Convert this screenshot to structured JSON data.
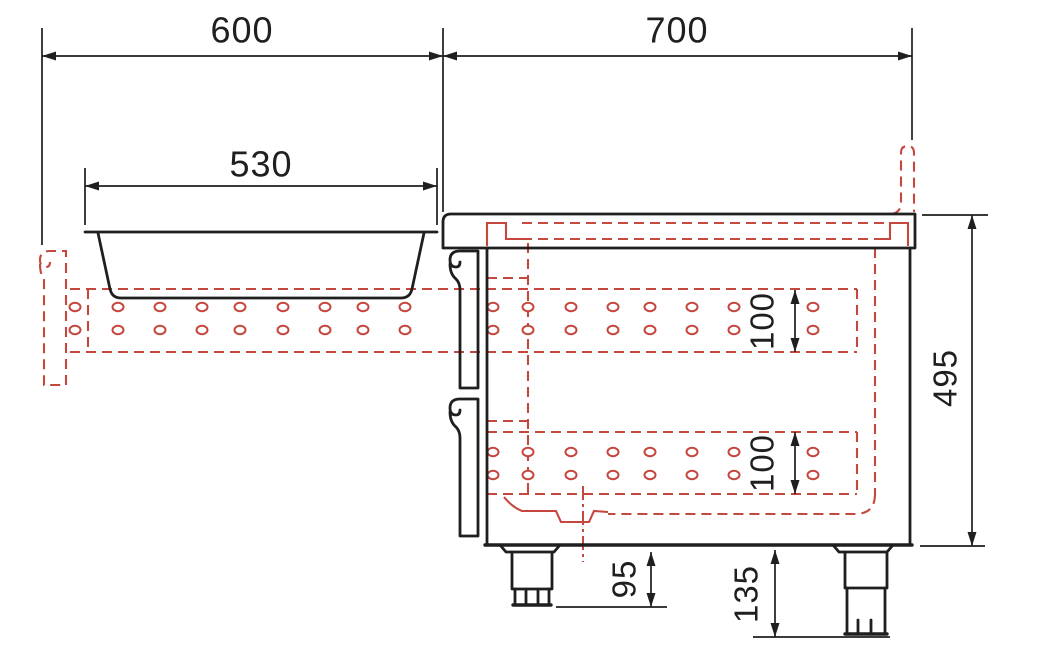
{
  "drawing": {
    "kind": "technical-cross-section",
    "colors": {
      "line": "#1f1f1f",
      "hidden": "#c5473e",
      "background": "#ffffff"
    },
    "labels": {
      "width_left": "600",
      "width_right": "700",
      "basin_width": "530",
      "body_height": "495",
      "element_upper_height": "100",
      "element_lower_height": "100",
      "foot_retracted": "95",
      "foot_extended": "135"
    },
    "perforations": {
      "rx": 5.5,
      "ry": 4.2,
      "bands": [
        {
          "rows": [
            307,
            330
          ],
          "cols": [
            75,
            118,
            160,
            202,
            240,
            283,
            325,
            363,
            405,
            493,
            528,
            571,
            613,
            650,
            692,
            734,
            813
          ]
        },
        {
          "rows": [
            452,
            475
          ],
          "cols": [
            493,
            528,
            571,
            613,
            650,
            692,
            734,
            813
          ]
        }
      ]
    }
  }
}
